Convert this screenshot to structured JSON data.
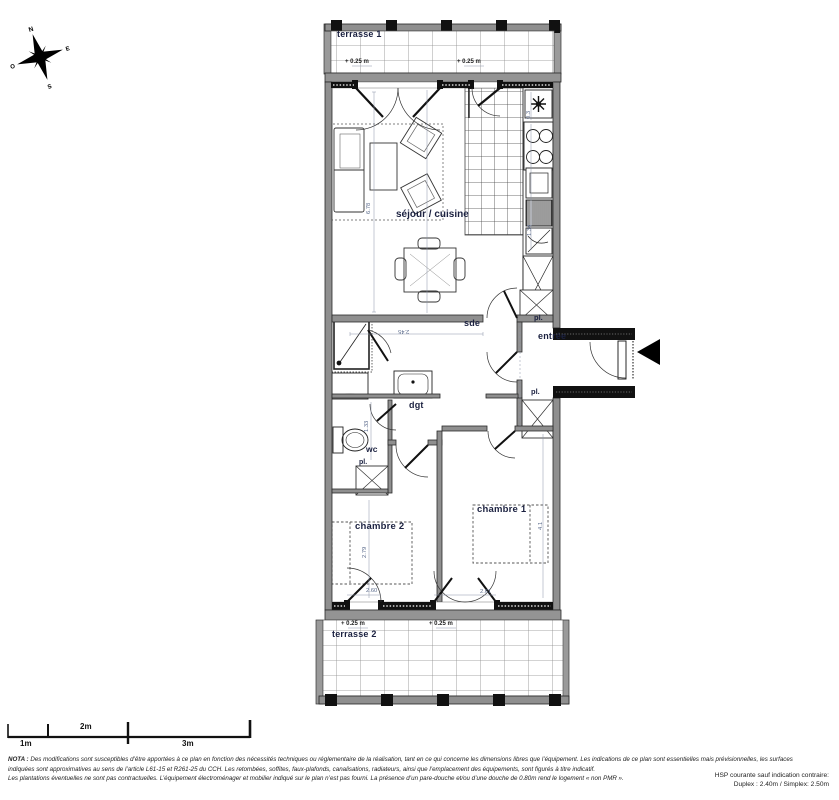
{
  "title": "floor-plan",
  "colors": {
    "wall_gray": "#8f8f8f",
    "wall_dark": "#111111",
    "label_navy": "#1b2140",
    "dim_blue": "#5b6b8c",
    "paper": "#ffffff"
  },
  "compass": {
    "n": "N",
    "e": "E",
    "s": "S",
    "o": "O"
  },
  "rooms": {
    "terrasse1": "terrasse 1",
    "sejour": "séjour / cuisine",
    "sde": "sde",
    "entree": "entrée",
    "dgt": "dgt",
    "wc": "wc",
    "pl_top": "pl.",
    "pl_bottom": "pl.",
    "pl_wc": "pl.",
    "chambre1": "chambre 1",
    "chambre2": "chambre 2",
    "terrasse2": "terrasse 2"
  },
  "levels": {
    "t1_left": "+ 0.25 m",
    "t1_right": "+ 0.25 m",
    "t2_left": "+ 0.25 m",
    "t2_right": "+ 0.25 m"
  },
  "dims": [
    {
      "t": "6.78"
    },
    {
      "t": "0.3"
    },
    {
      "t": "1.34"
    },
    {
      "t": "2.45"
    },
    {
      "t": "1.33"
    },
    {
      "t": "2.79"
    },
    {
      "t": "4.1"
    },
    {
      "t": "2.60"
    },
    {
      "t": "2.61"
    }
  ],
  "scalebar": {
    "m1": "1m",
    "m2": "2m",
    "m3": "3m"
  },
  "nota": {
    "label": "NOTA :",
    "line1": "Des modifications sont susceptibles d’être apportées à ce plan en fonction des nécessités techniques ou réglementaire de la réalisation, tant en ce qui concerne les dimensions libres que l’équipement. Les indications de ce plan sont essentielles mais prévisionnelles, les surfaces",
    "line2": "indiquées sont approximatives au sens de l’article L61-15 et R261-25 du CCH. Les retombées, soffites, faux-plafonds, canalisations, radiateurs, ainsi que l’emplacement des équipements, sont figurés à titre indicatif.",
    "line3": "Les plantations éventuelles ne sont pas contractuelles. L’équipement électroménager et mobilier indiqué sur le plan n’est pas fourni. La présence d’un pare-douche et/ou d’une douche de 0.80m rend le logement « non PMR »."
  },
  "hsp": {
    "line1": "HSP courante sauf indication contraire:",
    "line2": "Duplex : 2.40m / Simplex: 2.50m"
  }
}
